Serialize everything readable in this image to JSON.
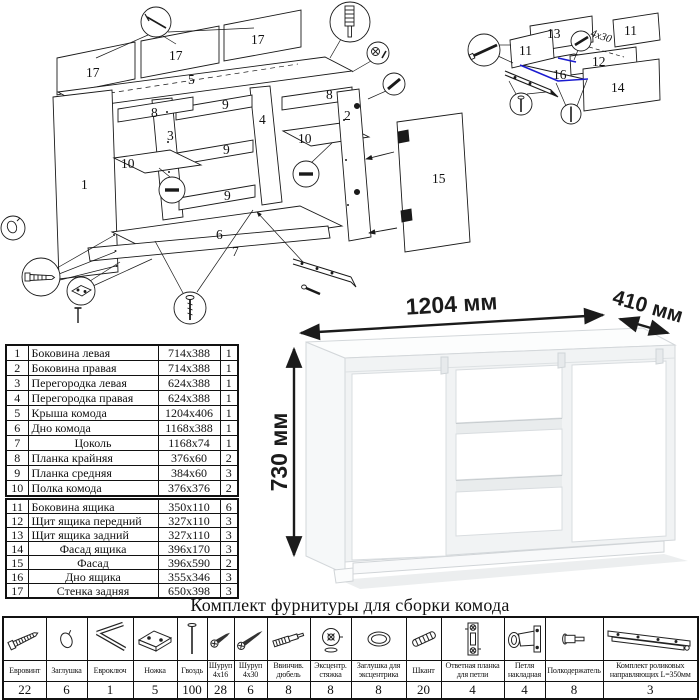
{
  "doc": {
    "title": "Комплект фурнитуры для сборки комода"
  },
  "dimensions": {
    "width": "1204 мм",
    "depth": "410 мм",
    "height": "730 мм"
  },
  "exploded": {
    "labels": {
      "p1": "1",
      "p2": "2",
      "p3": "3",
      "p4": "4",
      "p5": "5",
      "p6": "6",
      "p7": "7",
      "p8a": "8",
      "p8b": "8",
      "p9a": "9",
      "p9b": "9",
      "p9c": "9",
      "p10a": "10",
      "p10b": "10",
      "p15": "15",
      "p17a": "17",
      "p17b": "17",
      "p17c": "17"
    }
  },
  "drawer": {
    "labels": {
      "p11a": "11",
      "p11b": "11",
      "p12": "12",
      "p13": "13",
      "p14": "14",
      "p16": "16"
    },
    "screw_note": "4х30"
  },
  "colors": {
    "line": "#1a1a1a",
    "accent_blue": "#1b1bd0",
    "shade": "#e9eced"
  },
  "parts": {
    "rows": [
      {
        "n": "1",
        "name": "Боковина левая",
        "size": "714х388",
        "q": "1"
      },
      {
        "n": "2",
        "name": "Боковина правая",
        "size": "714х388",
        "q": "1"
      },
      {
        "n": "3",
        "name": "Перегородка левая",
        "size": "624х388",
        "q": "1"
      },
      {
        "n": "4",
        "name": "Перегородка правая",
        "size": "624х388",
        "q": "1"
      },
      {
        "n": "5",
        "name": "Крыша комода",
        "size": "1204х406",
        "q": "1"
      },
      {
        "n": "6",
        "name": "Дно комода",
        "size": "1168х388",
        "q": "1"
      },
      {
        "n": "7",
        "name": "Цоколь",
        "size": "1168х74",
        "q": "1"
      },
      {
        "n": "8",
        "name": "Планка крайняя",
        "size": "376х60",
        "q": "2"
      },
      {
        "n": "9",
        "name": "Планка средняя",
        "size": "384х60",
        "q": "3"
      },
      {
        "n": "10",
        "name": "Полка комода",
        "size": "376х376",
        "q": "2"
      },
      {
        "n": "11",
        "name": "Боковина ящика",
        "size": "350х110",
        "q": "6"
      },
      {
        "n": "12",
        "name": "Щит ящика передний",
        "size": "327х110",
        "q": "3"
      },
      {
        "n": "13",
        "name": "Щит ящика задний",
        "size": "327х110",
        "q": "3"
      },
      {
        "n": "14",
        "name": "Фасад ящика",
        "size": "396х170",
        "q": "3"
      },
      {
        "n": "15",
        "name": "Фасад",
        "size": "396х590",
        "q": "2"
      },
      {
        "n": "16",
        "name": "Дно ящика",
        "size": "355х346",
        "q": "3"
      },
      {
        "n": "17",
        "name": "Стенка задняя",
        "size": "650х398",
        "q": "3"
      }
    ]
  },
  "hardware": {
    "items": [
      {
        "name": "Евровинт",
        "count": "22"
      },
      {
        "name": "Заглушка",
        "count": "6"
      },
      {
        "name": "Евроключ",
        "count": "1"
      },
      {
        "name": "Ножка",
        "count": "5"
      },
      {
        "name": "Гвоздь",
        "count": "100"
      },
      {
        "name": "Шуруп 4х16",
        "count": "28"
      },
      {
        "name": "Шуруп 4х30",
        "count": "6"
      },
      {
        "name": "Ввинчив. дюбель",
        "count": "8"
      },
      {
        "name": "Эксцентр. стяжка",
        "count": "8"
      },
      {
        "name": "Заглушка для эксцентрика",
        "count": "8"
      },
      {
        "name": "Шкант",
        "count": "20"
      },
      {
        "name": "Ответная планка для петли",
        "count": "4"
      },
      {
        "name": "Петля накладная",
        "count": "4"
      },
      {
        "name": "Полкодержатель",
        "count": "8"
      },
      {
        "name": "Комплект роликовых направляющих L=350мм",
        "count": "3"
      }
    ]
  }
}
